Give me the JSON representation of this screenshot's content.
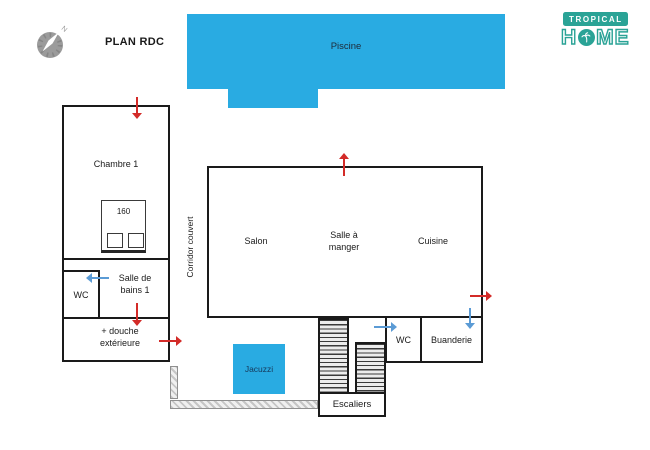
{
  "title": "PLAN RDC",
  "colors": {
    "wall": "#1a1a1a",
    "pool": "#29abe2",
    "arrow-red": "#d32b28",
    "arrow-blue": "#5b9bd5",
    "teal": "#2aa396",
    "compass-gray": "#9b9b9b"
  },
  "compass": {
    "north": "N"
  },
  "brand": {
    "badge": "TROPICAL",
    "home_left": "H",
    "home_right": "ME"
  },
  "pool": {
    "label": "Piscine"
  },
  "left_wing": {
    "chambre": "Chambre 1",
    "bed_size": "160",
    "wc": "WC",
    "bathroom": "Salle de bains 1",
    "outdoor_shower": "+ douche extérieure"
  },
  "corridor": {
    "label": "Corridor couvert"
  },
  "main_wing": {
    "salon": "Salon",
    "dining": "Salle à manger",
    "kitchen": "Cuisine"
  },
  "annex": {
    "wc": "WC",
    "laundry": "Buanderie"
  },
  "exterior": {
    "jacuzzi": "Jacuzzi",
    "stairs": "Escaliers"
  },
  "arrows": [
    {
      "id": "chambre-entrance",
      "direction": "down",
      "color": "red"
    },
    {
      "id": "bathroom-to-shower",
      "direction": "down",
      "color": "red"
    },
    {
      "id": "shower-exit",
      "direction": "right",
      "color": "red"
    },
    {
      "id": "main-top-entrance",
      "direction": "up",
      "color": "red"
    },
    {
      "id": "kitchen-exit",
      "direction": "right",
      "color": "red"
    },
    {
      "id": "bathroom-to-wc",
      "direction": "left",
      "color": "blue"
    },
    {
      "id": "annex-wc-entrance",
      "direction": "right",
      "color": "blue"
    },
    {
      "id": "laundry-entrance",
      "direction": "down",
      "color": "blue"
    }
  ]
}
